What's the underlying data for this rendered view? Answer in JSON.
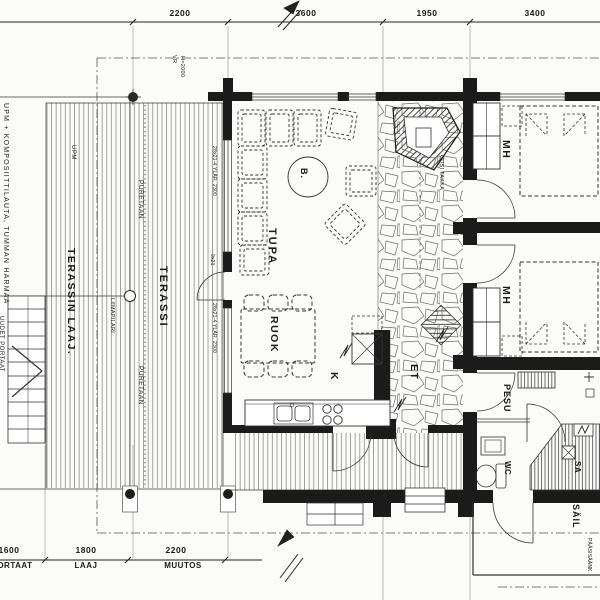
{
  "dims": {
    "top": [
      "2200",
      "3600",
      "1950",
      "3400"
    ],
    "bottom": [
      "1600",
      "1800",
      "2200"
    ],
    "bottom_labels": [
      "PORTAAT",
      "LAAJ",
      "MUUTOS"
    ]
  },
  "rooms": {
    "tupa": "TUPA",
    "ruok": "RUOK",
    "k": "K",
    "et": "ET",
    "mh": "MH",
    "pesu": "PESU",
    "wc": "WC",
    "sa": "SA",
    "sail": "SÄIL",
    "terassi": "TERASSI",
    "terassin_laaj": "TERASSIN LAAJ.",
    "b": "B."
  },
  "notes": {
    "cladding": "UPM + KOMPOSIITTILAUTA, TUMMAN HARMAA",
    "upm": "UPM",
    "puretaan": "PURETAAN",
    "liimapilari": "LIIMAPILARI",
    "uudet_portaat": "UUDET PORTAAT",
    "vr": "VR",
    "vr_h": "H=2000",
    "window_spec": "28x21-4 YLÄR. 2300",
    "door_spec": "9x21",
    "uusi_takka": "UUSI TAKKA",
    "paasisaank": "PÄÄSISÄÄNK."
  },
  "colors": {
    "wall": "#1b1b1b",
    "line": "#2b2b2b",
    "paper": "#fbfbf9"
  }
}
